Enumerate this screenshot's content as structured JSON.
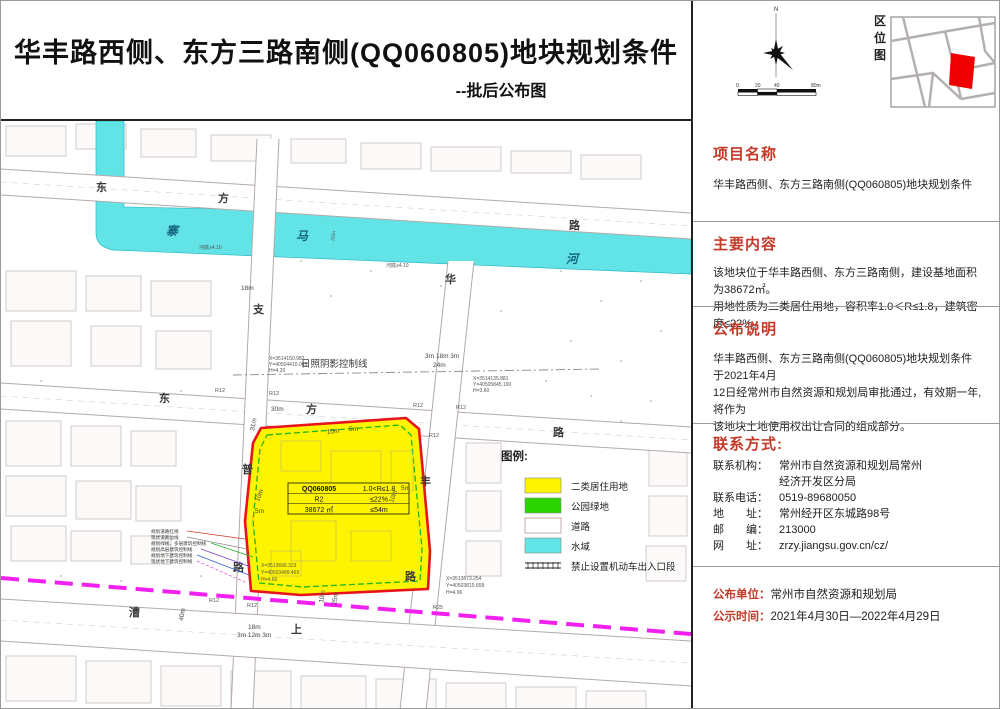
{
  "header": {
    "title": "华丰路西侧、东方三路南侧(QQ060805)地块规划条件",
    "subtitle": "--批后公布图"
  },
  "topright": {
    "north_label": "N",
    "scale_ticks": [
      "0",
      "20",
      "40",
      "80m"
    ],
    "location_map_label": "区位图",
    "location_parcel_color": "#ee0000"
  },
  "panel": {
    "sections": [
      {
        "heading": "项目名称",
        "lines": [
          "华丰路西侧、东方三路南侧(QQ060805)地块规划条件"
        ]
      },
      {
        "heading": "主要内容",
        "lines": [
          "该地块位于华丰路西侧、东方三路南侧，建设基地面积为38672㎡。",
          "用地性质为二类居住用地，容积率1.0＜R≤1.8，建筑密度≤22%。"
        ]
      },
      {
        "heading": "公布说明",
        "lines": [
          "华丰路西侧、东方三路南侧(QQ060805)地块规划条件 于2021年4月",
          "12日经常州市自然资源和规划局审批通过，有效期一年,将作为",
          "该地块土地使用权出让合同的组成部分。"
        ]
      }
    ],
    "contact": {
      "heading": "联系方式:",
      "rows": [
        {
          "label": "联系机构：",
          "value": "常州市自然资源和规划局常州"
        },
        {
          "label": "",
          "value": "经济开发区分局"
        },
        {
          "label": "联系电话：",
          "value": "0519-89680050"
        },
        {
          "label": "地　　址：",
          "value": "常州经开区东城路98号"
        },
        {
          "label": "邮　　编：",
          "value": "213000"
        },
        {
          "label": "网　　址：",
          "value": "zrzy.jiangsu.gov.cn/cz/"
        }
      ]
    },
    "footer": [
      {
        "label": "公布单位：",
        "value": "常州市自然资源和规划局"
      },
      {
        "label": "公示时间：",
        "value": "2021年4月30日—2022年4月29日"
      }
    ]
  },
  "map": {
    "parcel": {
      "code": "QQ060805",
      "use": "R2",
      "area": "38672 ㎡",
      "far": "1.0<R≤1.8",
      "density": "≤22%",
      "height_limit": "≤54m",
      "fill": "#fff400",
      "border": "#e8141c"
    },
    "legend": {
      "title": "图例:",
      "items": [
        {
          "label": "二类居住用地",
          "color": "#fff400"
        },
        {
          "label": "公园绿地",
          "color": "#2ad500"
        },
        {
          "label": "道路",
          "color": "#ffffff"
        },
        {
          "label": "水域",
          "color": "#62e3e6"
        },
        {
          "label": "禁止设置机动车出入口段",
          "color": "line-symbol"
        }
      ]
    },
    "roads": {
      "dongfang_er": [
        "东",
        "方",
        "路"
      ],
      "dongfang_san": [
        "东",
        "方",
        "路"
      ],
      "zhipu": [
        "支",
        "普",
        "路"
      ],
      "huafeng": [
        "华",
        "丰",
        "路"
      ],
      "caoshang": [
        "漕",
        "上"
      ]
    },
    "river": {
      "chars": [
        "寨",
        "马",
        "河"
      ],
      "depth_note": "河底≥4.10",
      "width_note": "20m"
    },
    "shadow_line_label": "日照阴影控制线",
    "r_label": "R12",
    "r25_label": "R25",
    "dims": {
      "d18": "18m",
      "d30": "30m",
      "d31": "31m",
      "d3183": "3m 18m 3m",
      "d24": "24m",
      "d10": "10m",
      "d5": "5m",
      "d25": "25m",
      "d40": "40m",
      "d31253": "3m 12m 3m"
    },
    "coords": [
      {
        "l1": "X=3514150.982",
        "l2": "Y=40504410.065",
        "l3": "H=4.20"
      },
      {
        "l1": "X=3514135.881",
        "l2": "Y=40505845.190",
        "l3": "H=3.60"
      },
      {
        "l1": "X=3513696.323",
        "l2": "Y=40503489.469",
        "l3": "H=4.60"
      },
      {
        "l1": "X=3513873.254",
        "l2": "Y=40503810.658",
        "l3": "H=4.96"
      }
    ],
    "callouts": [
      "规划道路红线",
      "现状道路边线",
      "规划绿线、多层建筑控制线",
      "规划高层建筑控制线",
      "规划地下建筑控制线",
      "现状地下建筑控制线"
    ]
  }
}
